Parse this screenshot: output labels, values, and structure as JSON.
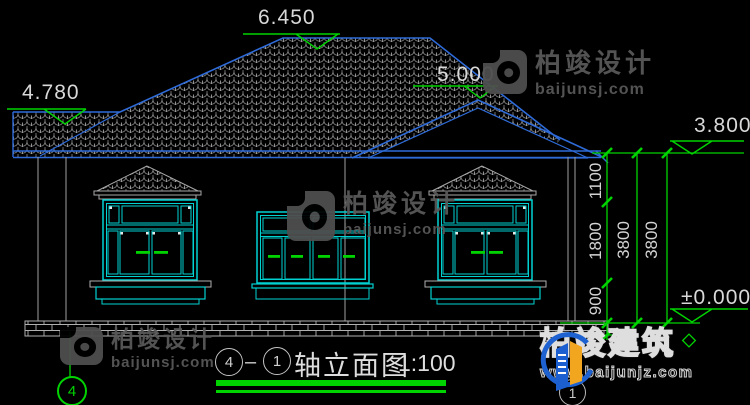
{
  "levels": {
    "ridge": "6.450",
    "left_roof": "4.780",
    "gable": "5.000",
    "eave": "3.800",
    "ground": "±0.000"
  },
  "dims": {
    "a": "1100",
    "b": "1800",
    "c": "900",
    "t1": "3800",
    "t2": "3800"
  },
  "axes": {
    "left": "4",
    "right": "1"
  },
  "title": {
    "axis_from": "4",
    "dash": "–",
    "axis_to": "1",
    "name": "轴立面图",
    "scale": "1:100"
  },
  "watermark": {
    "name": "柏竣设计",
    "site": "baijunsj.com"
  },
  "brand": {
    "name": "柏竣建筑",
    "site": "www.baijunjz.com"
  },
  "colors": {
    "line_blue": "#2e6bd8",
    "window_cyan": "#00d2d2",
    "annot_green": "#00d400",
    "tile_gray": "#9c9c9c"
  }
}
